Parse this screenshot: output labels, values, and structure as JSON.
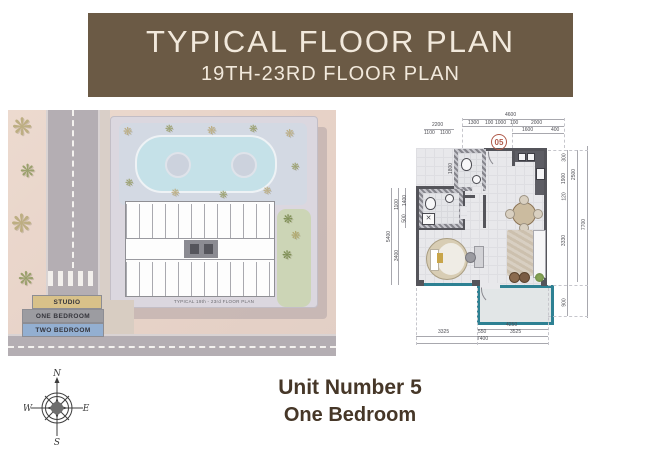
{
  "header": {
    "title": "TYPICAL FLOOR PLAN",
    "subtitle": "19TH-23RD FLOOR PLAN",
    "bg_color": "#6b5a45",
    "text_color": "#f2e9dc"
  },
  "site_plan": {
    "caption": "TYPICAL 19th - 23rd FLOOR PLAN",
    "legend": [
      {
        "label": "STUDIO",
        "color": "#d8c189"
      },
      {
        "label": "ONE BEDROOM",
        "color": "#9c9ca1"
      },
      {
        "label": "TWO BEDROOM",
        "color": "#93afd1"
      }
    ]
  },
  "unit_plan": {
    "unit_number": "05",
    "balcony_color": "#2e8193",
    "dims": {
      "top_total": "4600",
      "top_row": [
        "1300",
        "100",
        "1000",
        "100",
        "2000"
      ],
      "top_sub": [
        "1600",
        "400"
      ],
      "left_top": "2200",
      "left_top_row": [
        "1100",
        "1100"
      ],
      "v1800": "1800",
      "left": [
        "1100",
        "1400",
        "500",
        "3400"
      ],
      "left_outer": "5400",
      "right": [
        "300",
        "1900",
        "120",
        "3330",
        "900"
      ],
      "right_mid": "2500",
      "right_outer": "7700",
      "balcony_width": "4250",
      "bottom": [
        "3325",
        "550",
        "3525"
      ],
      "bottom_total": "7400"
    }
  },
  "compass": {
    "north": "N",
    "east": "E",
    "south": "S",
    "west": "W"
  },
  "footer": {
    "line1": "Unit Number 5",
    "line2": "One Bedroom"
  }
}
